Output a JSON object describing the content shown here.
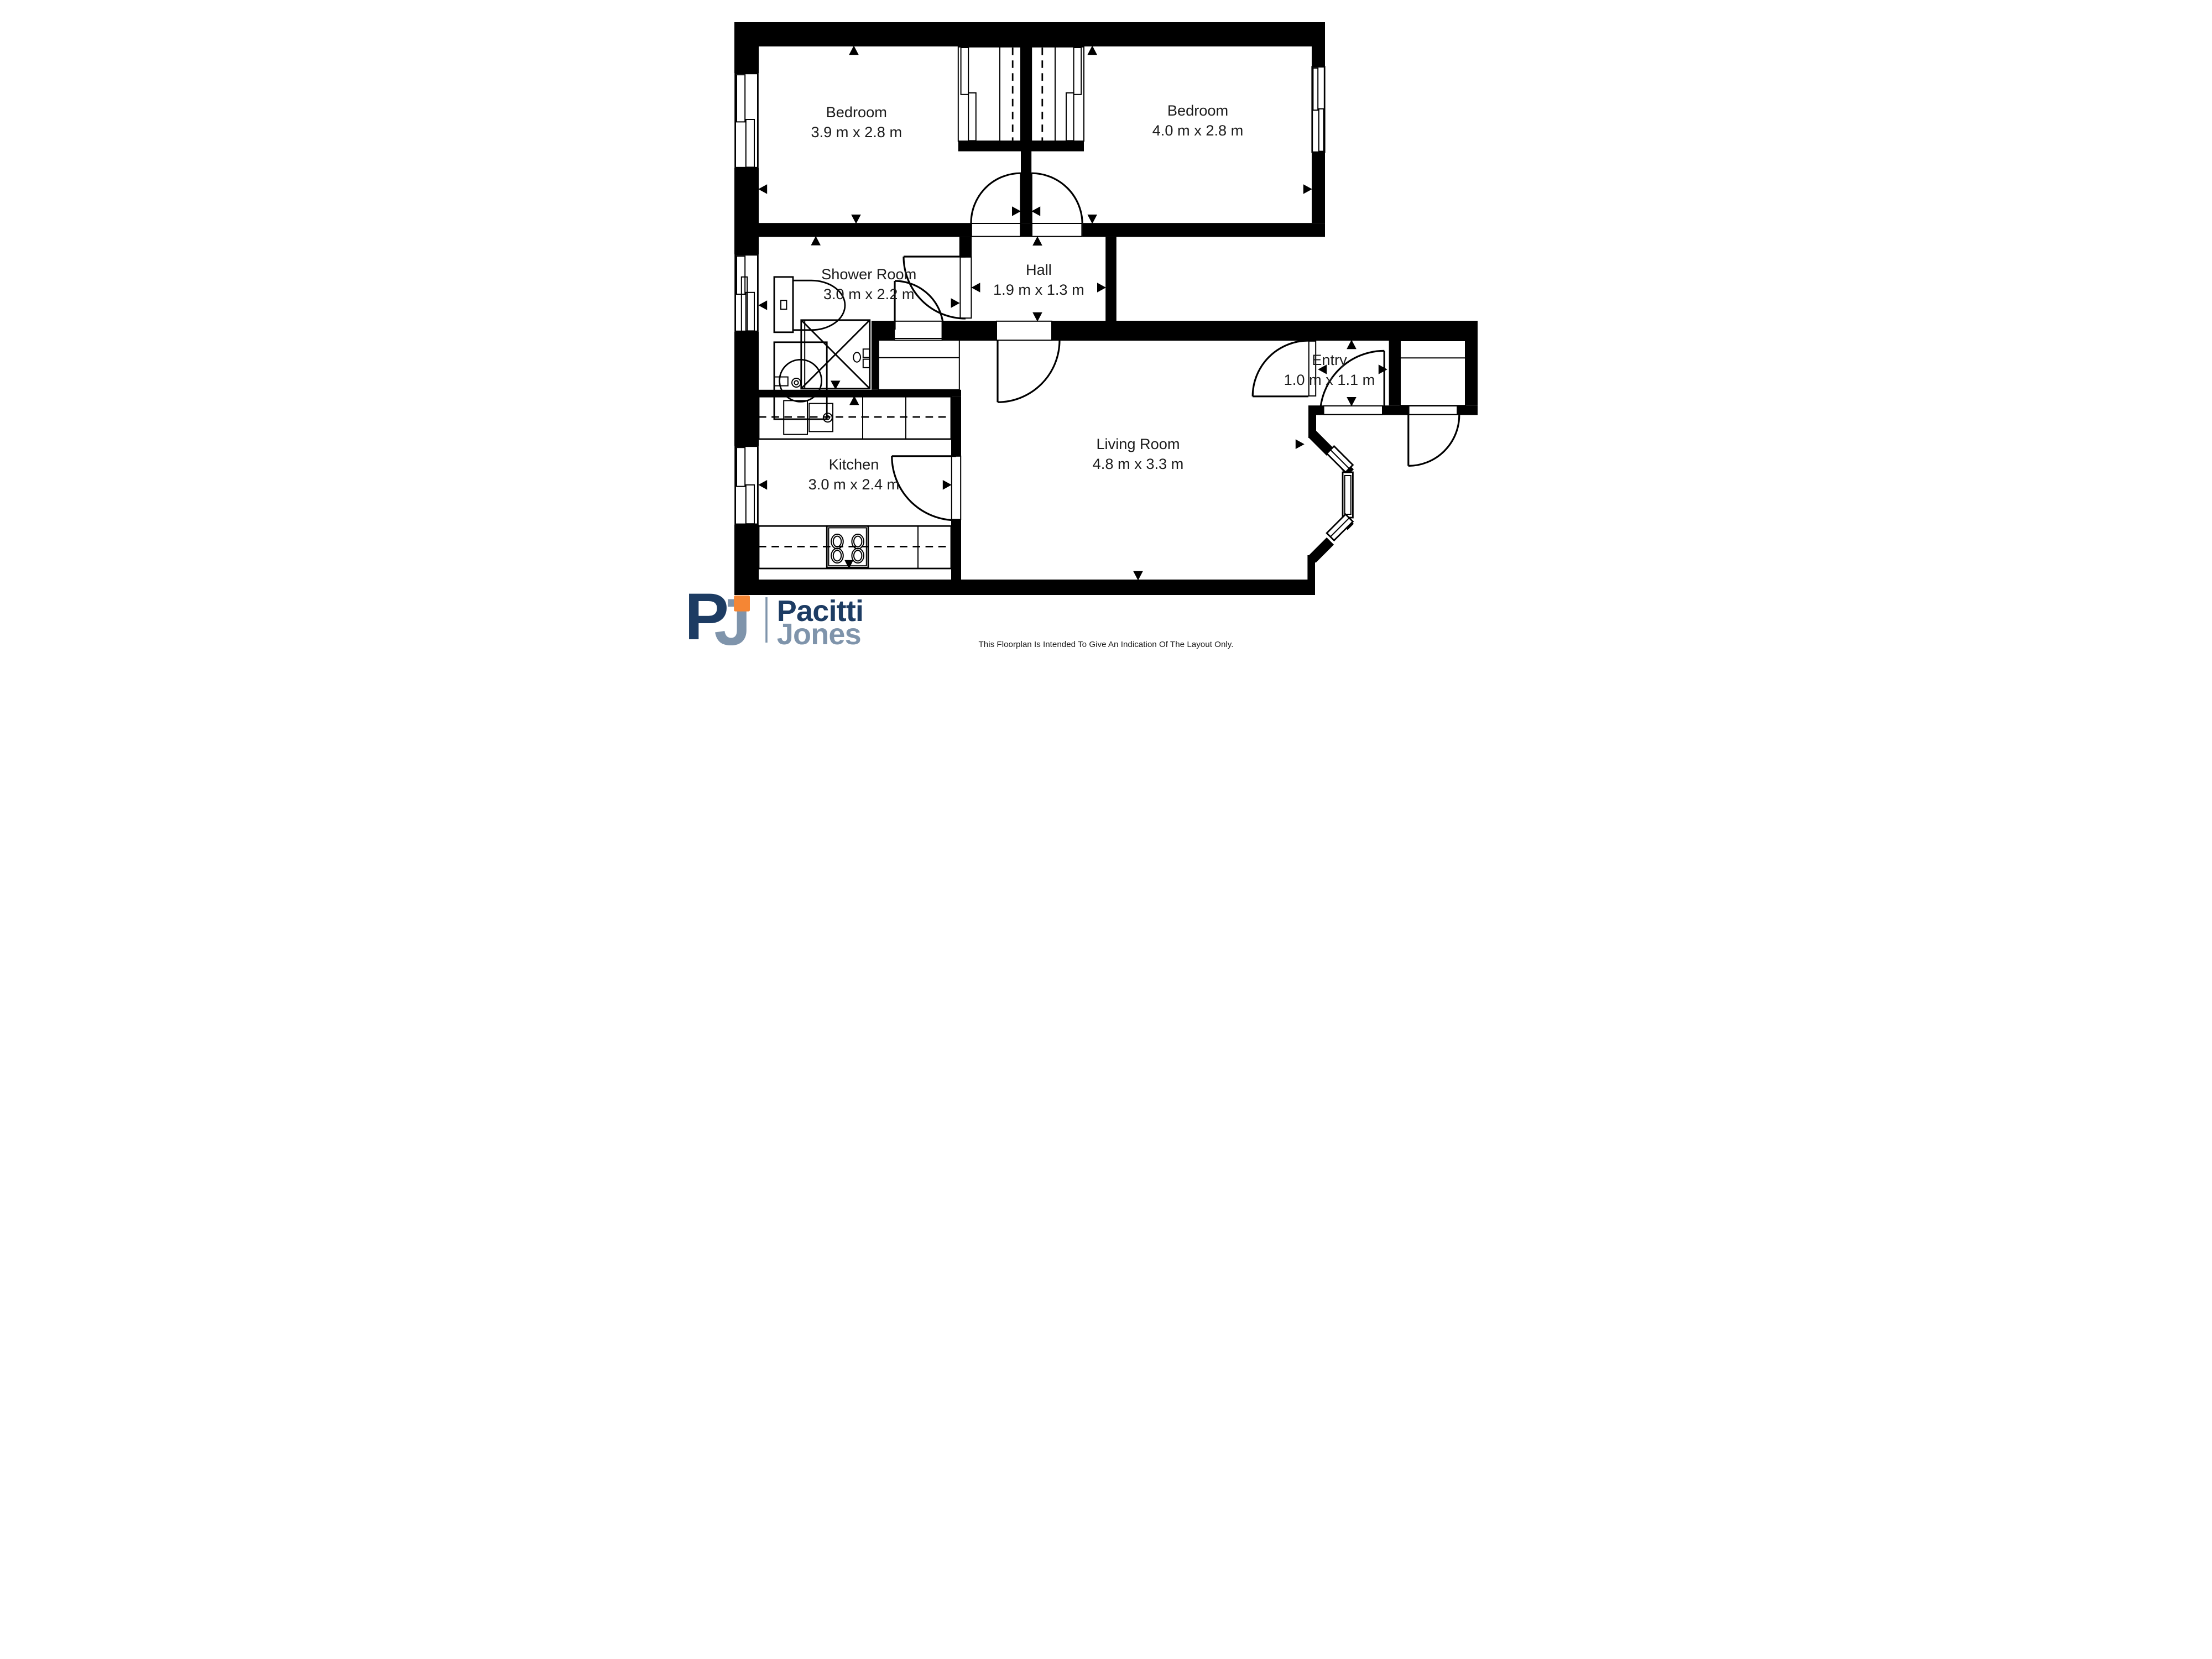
{
  "rooms": [
    {
      "label": "Bedroom",
      "dims": "3.9 m x 2.8 m"
    },
    {
      "label": "Bedroom",
      "dims": "4.0 m x 2.8 m"
    },
    {
      "label": "Shower Room",
      "dims": "3.0 m x 2.2 m"
    },
    {
      "label": "Hall",
      "dims": "1.9 m x 1.3 m"
    },
    {
      "label": "Entry",
      "dims": "1.0 m x 1.1 m"
    },
    {
      "label": "Living Room",
      "dims": "4.8 m x 3.3 m"
    },
    {
      "label": "Kitchen",
      "dims": "3.0 m x 2.4 m"
    }
  ],
  "logo": {
    "monogram_p": "P",
    "monogram_j": "J",
    "name_line1": "Pacitti",
    "name_line2": "Jones",
    "navy": "#1d3c63",
    "slate": "#7f94ab",
    "orange": "#f58634"
  },
  "footer": {
    "disclaimer": "This Floorplan Is Intended To Give An Indication Of The Layout Only."
  }
}
